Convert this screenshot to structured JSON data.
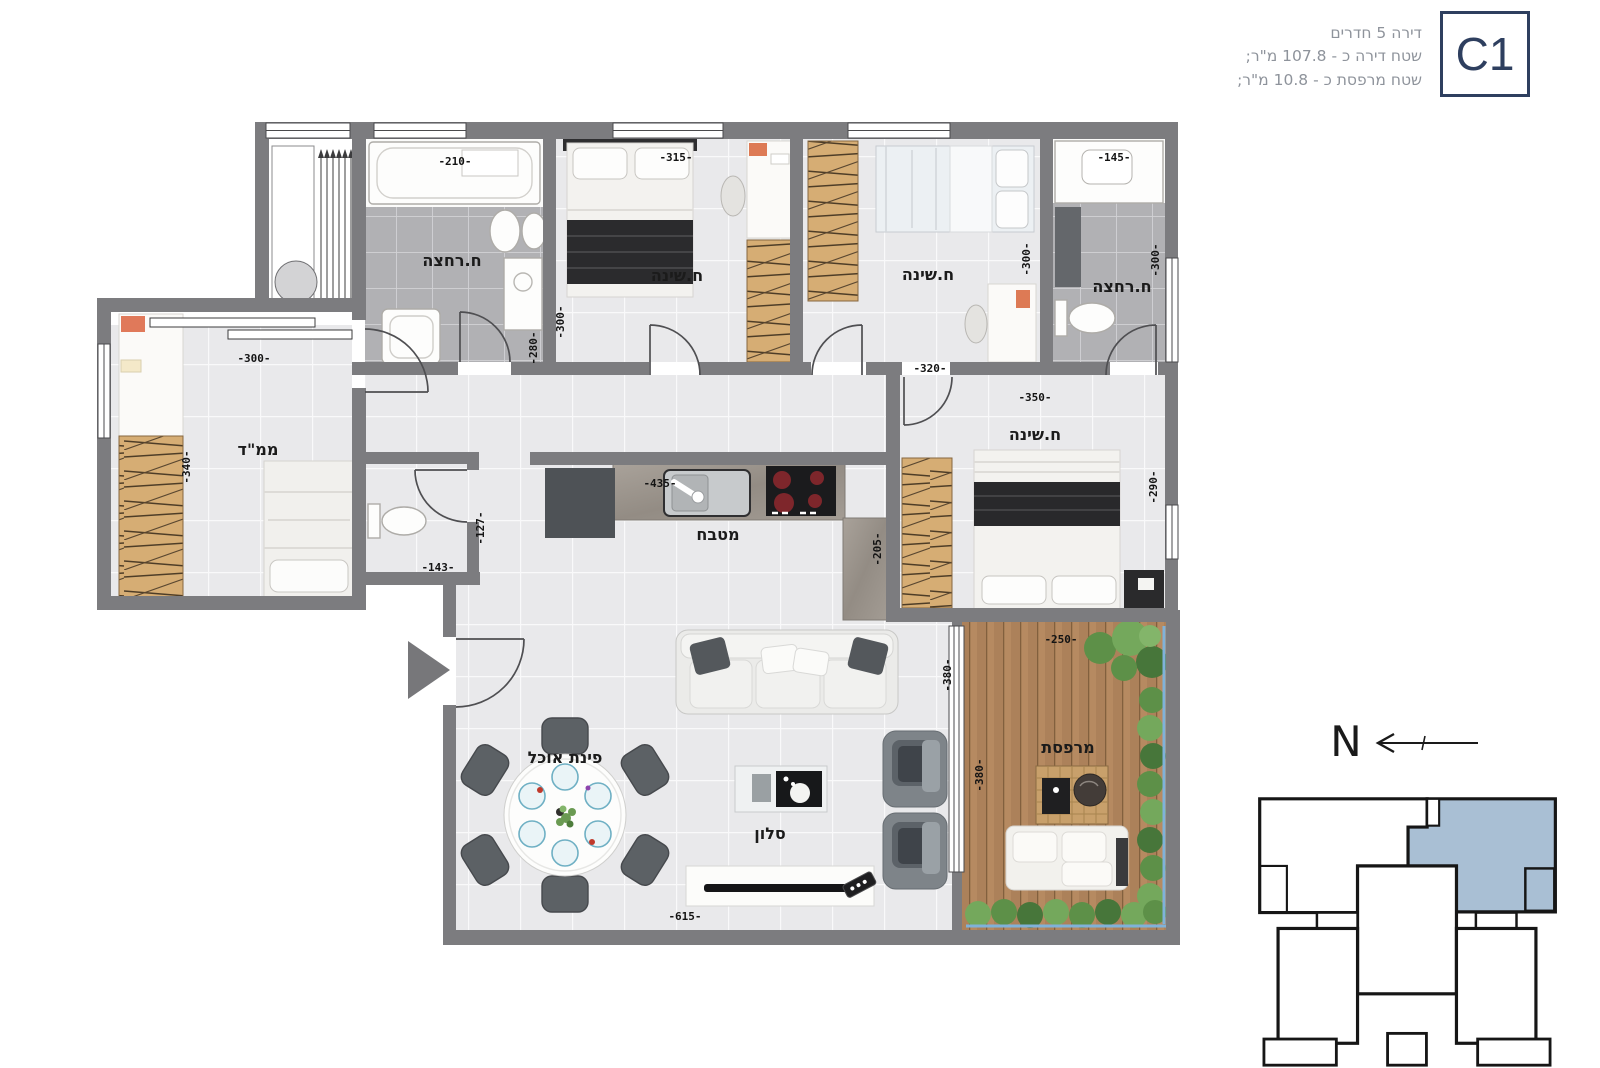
{
  "header": {
    "unit_code": "C1",
    "line1": "דירה 5 חדרים",
    "line2": "שטח דירה כ - 107.8 מ\"ר;",
    "line3": "שטח מרפסת כ - 10.8 מ\"ר;"
  },
  "compass": {
    "north_label": "N"
  },
  "plan": {
    "rooms": {
      "bathroom_top_left": {
        "label": "ח.רחצה",
        "w": "-210-",
        "h": "-280-"
      },
      "bedroom_1": {
        "label": "ח.שינה",
        "w": "-315-",
        "h": "-300-"
      },
      "bedroom_2": {
        "label": "ח.שינה",
        "w": "-320-",
        "h": "-300-"
      },
      "bathroom_top_right": {
        "label": "ח.רחצה",
        "w": "-145-",
        "h": "-300-"
      },
      "mamad": {
        "label": "ממ\"ד",
        "w": "-300-",
        "h": "-340-"
      },
      "wc": {
        "w": "-143-",
        "h": "-127-"
      },
      "kitchen": {
        "label": "מטבח",
        "w": "-435-",
        "h": "-205-"
      },
      "master_bedroom": {
        "label": "ח.שינה",
        "w": "-350-",
        "h": "-290-"
      },
      "dining": {
        "label": "פינת אוכל"
      },
      "living": {
        "label": "סלון",
        "w": "-615-",
        "h": "-380-"
      },
      "balcony": {
        "label": "מרפסת",
        "w": "-250-",
        "h": "-380-"
      }
    }
  },
  "colors": {
    "accent_navy": "#2e3f5f",
    "unit_highlight": "#a9bfd4",
    "wall_gray": "#7c7c7f"
  }
}
